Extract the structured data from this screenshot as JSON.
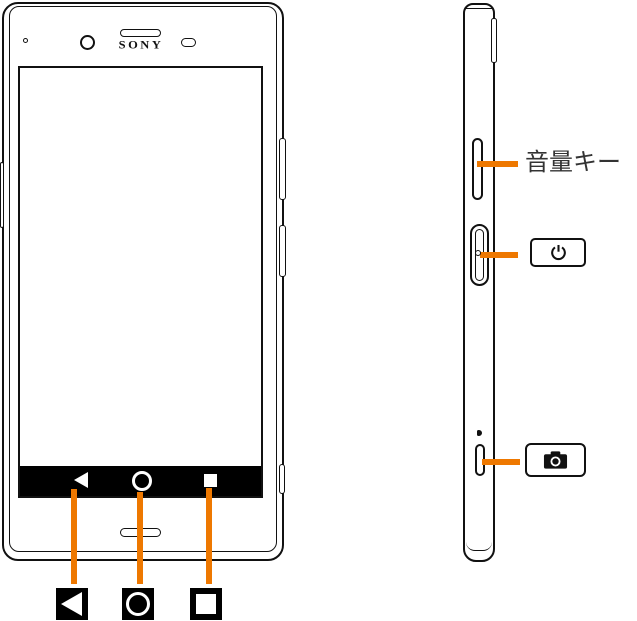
{
  "front": {
    "brand_logo": "SONY",
    "navbar": {
      "icons": [
        "back-icon",
        "home-icon",
        "recent-apps-icon"
      ]
    },
    "legend_icons": [
      "back-key-icon",
      "home-key-icon",
      "recent-apps-key-icon"
    ]
  },
  "side": {
    "volume_label": "音量キー",
    "callout_icons": [
      "power-icon",
      "camera-icon"
    ]
  },
  "colors": {
    "callout_orange": "#EE7800",
    "outline_black": "#111111",
    "navbar_black": "#000000"
  }
}
